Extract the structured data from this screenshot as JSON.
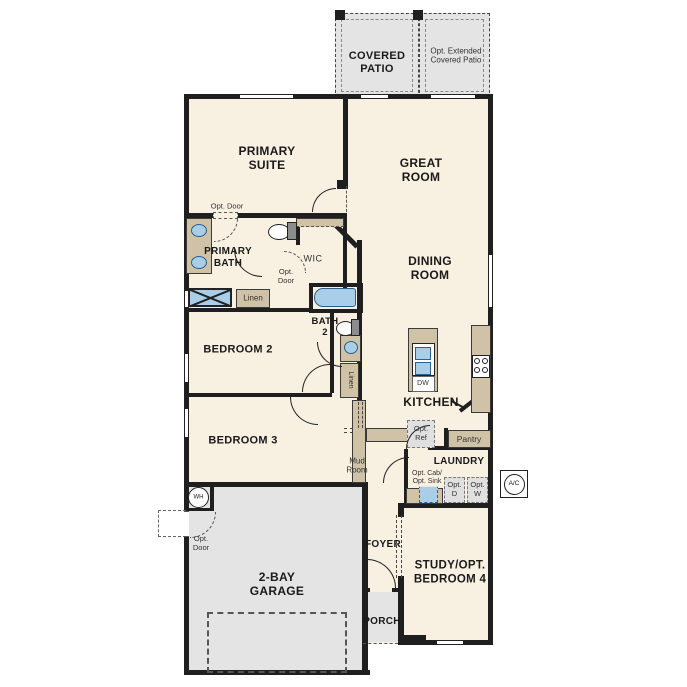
{
  "plan_title": "single-story floor plan",
  "colors": {
    "wall": "#1f1f1f",
    "floor": "#f8f0e1",
    "concrete": "#e4e4e4",
    "cabinet": "#cfc2a6",
    "fixture_fill": "#a9cee9",
    "fixture_stroke": "#2e5f8a",
    "optional_dashed": "#777777"
  },
  "rooms": {
    "covered_patio": "COVERED\nPATIO",
    "opt_extended_patio": "Opt. Extended\nCovered Patio",
    "primary_suite": "PRIMARY\nSUITE",
    "great_room": "GREAT\nROOM",
    "primary_bath": "PRIMARY\nBATH",
    "wic": "WIC",
    "dining_room": "DINING\nROOM",
    "bath_2": "BATH\n2",
    "bedroom_2": "BEDROOM 2",
    "bedroom_3": "BEDROOM 3",
    "kitchen": "KITCHEN",
    "laundry": "LAUNDRY",
    "mud_room": "Mud\nRoom",
    "foyer": "FOYER",
    "garage": "2-BAY\nGARAGE",
    "study": "STUDY/OPT.\nBEDROOM 4",
    "porch": "PORCH"
  },
  "annotations": {
    "opt_door_suite": "Opt. Door",
    "opt_door_wic": "Opt.\nDoor",
    "opt_door_garage": "Opt.\nDoor",
    "linen_primary": "Linen",
    "linen_hall": "Linen",
    "dishwasher": "DW",
    "opt_ref": "Opt.\nRef",
    "pantry": "Pantry",
    "opt_cab_sink": "Opt. Cab/\nOpt. Sink",
    "opt_dryer": "Opt.\nD",
    "opt_washer": "Opt.\nW",
    "ac_unit": "A/C",
    "water_heater": "WH"
  }
}
